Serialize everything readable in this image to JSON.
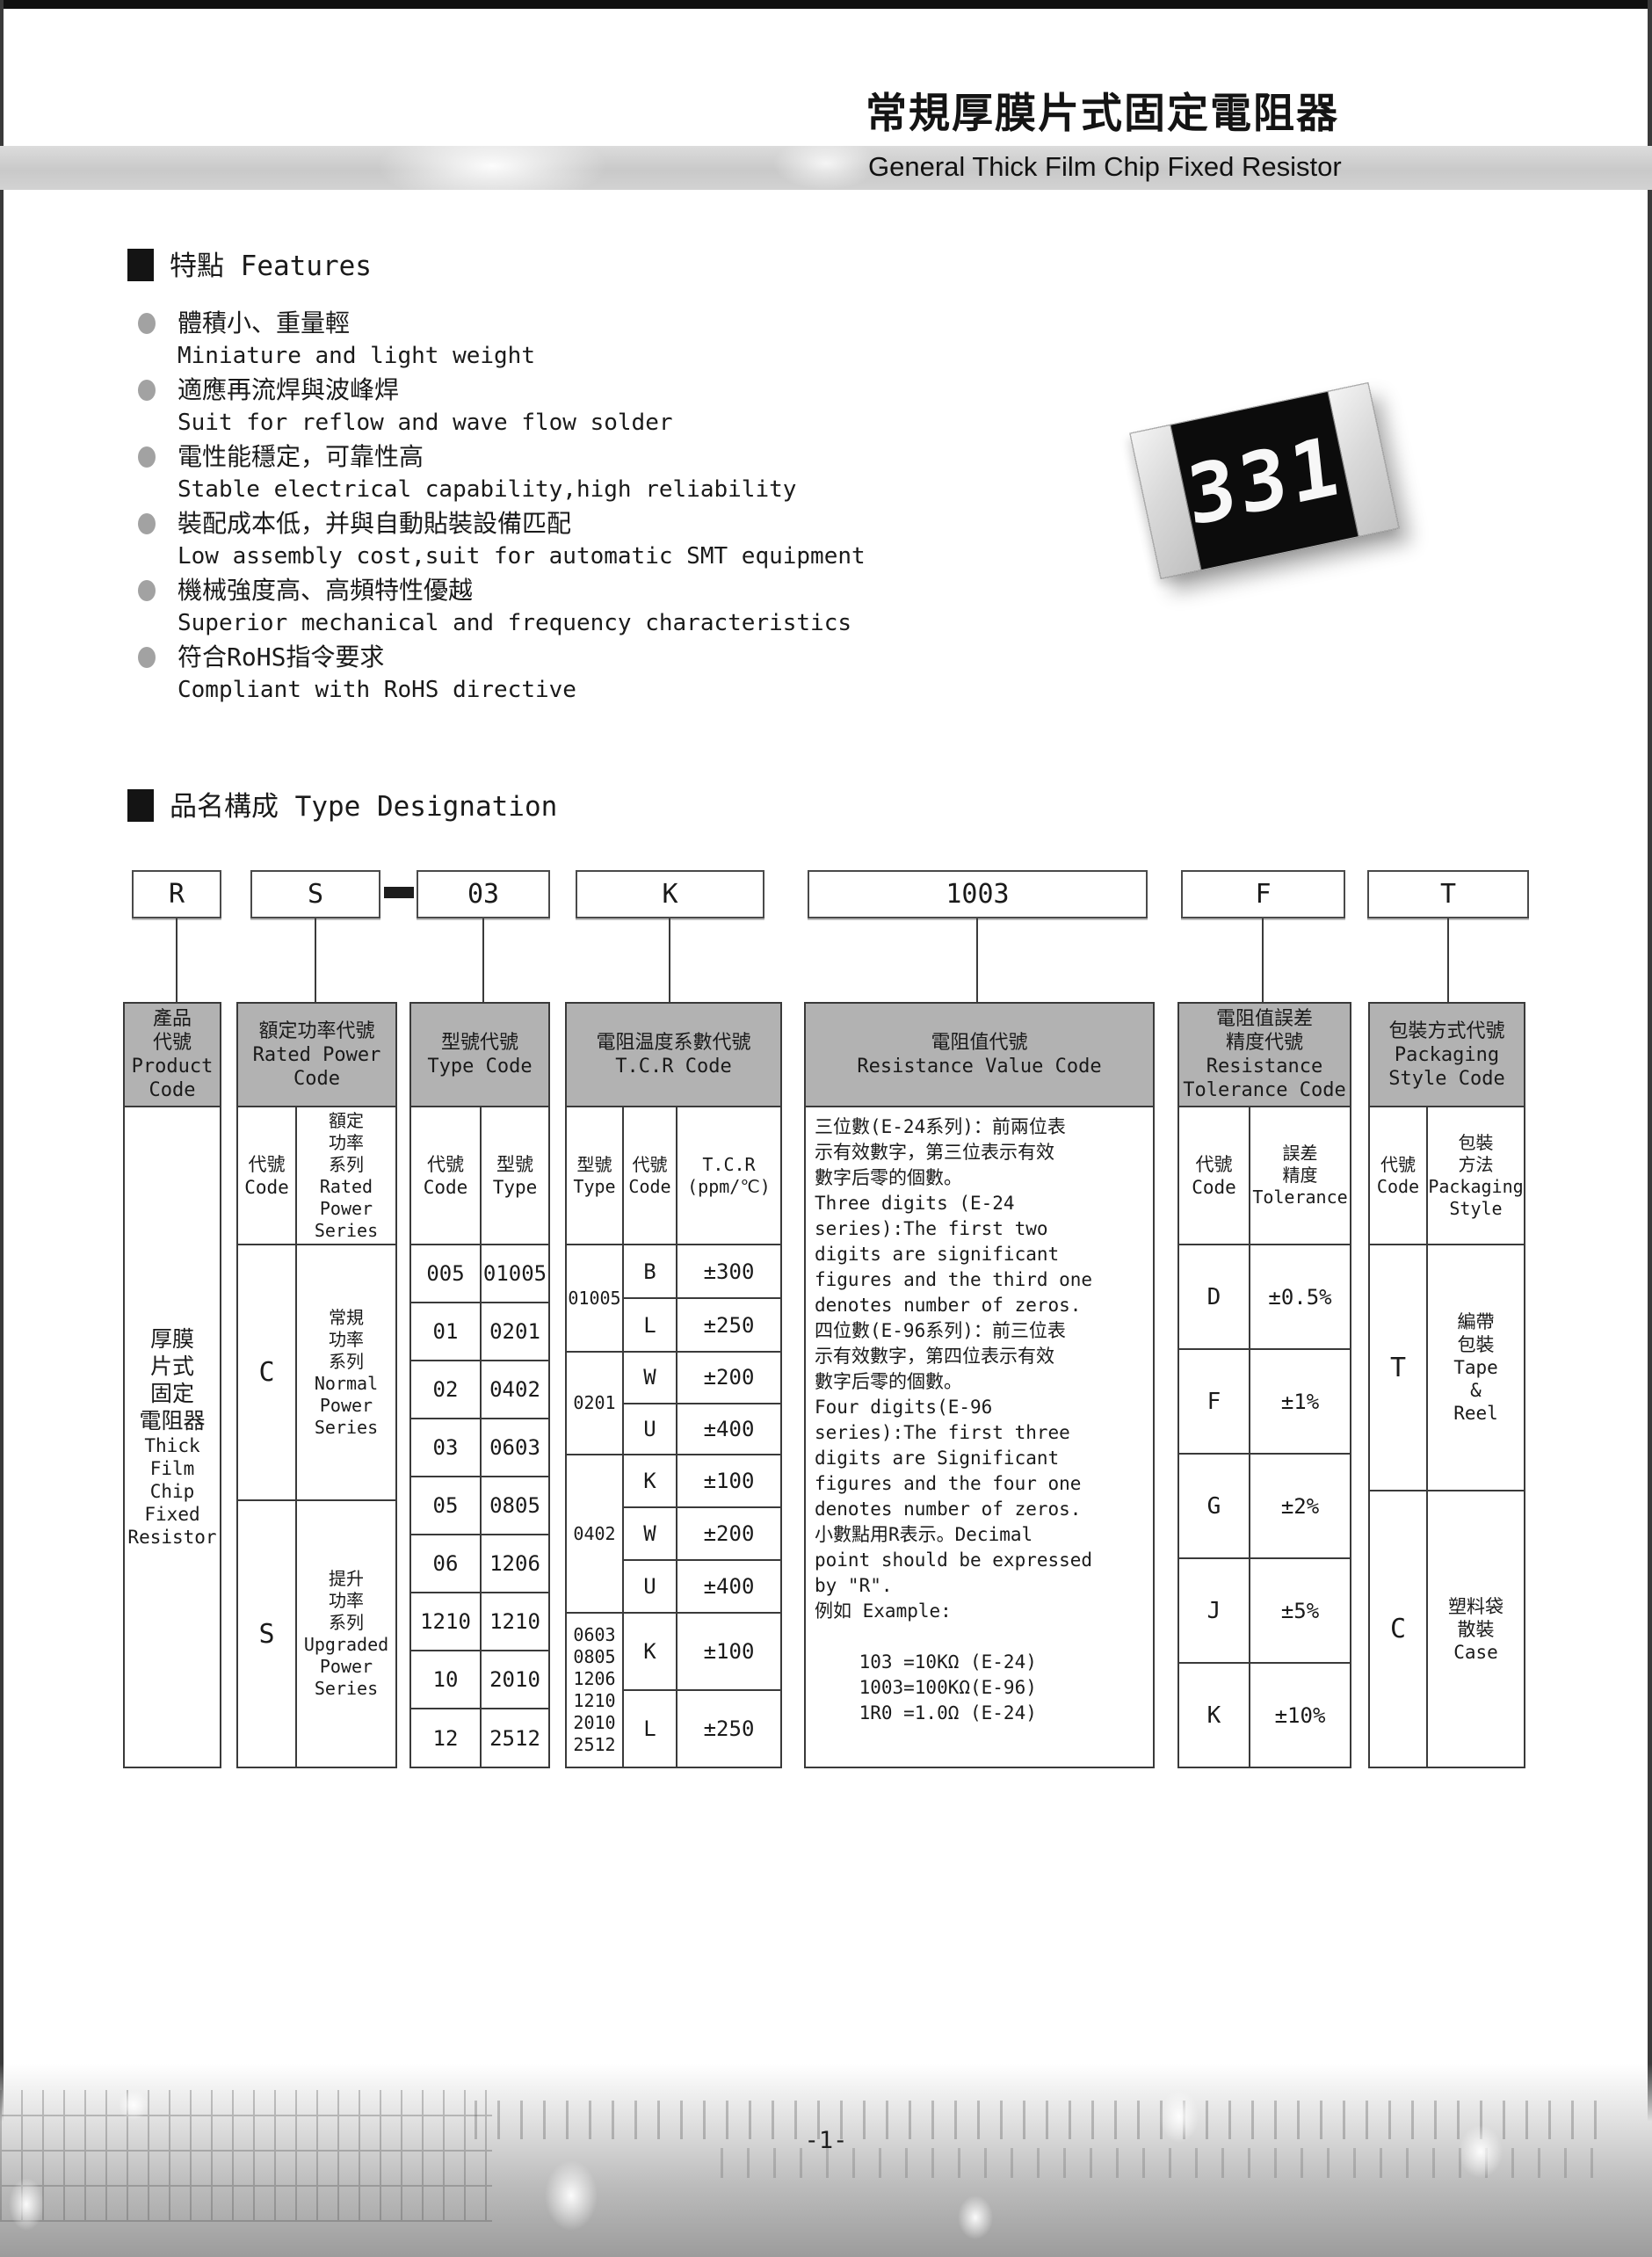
{
  "page": {
    "title_zh": "常規厚膜片式固定電阻器",
    "title_en": "General Thick Film Chip Fixed Resistor",
    "page_number": "-1-",
    "resistor_marking": "331"
  },
  "features": {
    "heading": "特點 Features",
    "items": [
      {
        "zh": "體積小、重量輕",
        "en": "Miniature and light weight"
      },
      {
        "zh": "適應再流焊與波峰焊",
        "en": "Suit for reflow and wave flow solder"
      },
      {
        "zh": "電性能穩定，可靠性高",
        "en": "Stable electrical capability,high reliability"
      },
      {
        "zh": "裝配成本低，并與自動貼裝設備匹配",
        "en": "Low assembly cost,suit for automatic SMT equipment"
      },
      {
        "zh": "機械強度高、高頻特性優越",
        "en": "Superior mechanical and frequency characteristics"
      },
      {
        "zh": "符合RoHS指令要求",
        "en": "Compliant with RoHS directive"
      }
    ]
  },
  "designation": {
    "heading": "品名構成  Type Designation",
    "boxes": {
      "b1": "R",
      "b2": "S",
      "b3": "03",
      "b4": "K",
      "b5": "1003",
      "b6": "F",
      "b7": "T"
    }
  },
  "table": {
    "product": {
      "header": "產品\n代號\nProduct\nCode",
      "body_zh": "厚膜\n片式\n固定\n電阻器",
      "body_en": "Thick\nFilm\nChip\nFixed\nResistor"
    },
    "power": {
      "header": "額定功率代號\nRated Power\nCode",
      "sub_code": "代號\nCode",
      "sub_series": "額定\n功率\n系列\nRated\nPower\nSeries",
      "rows": [
        {
          "code": "C",
          "series": "常規\n功率\n系列\nNormal\nPower\nSeries"
        },
        {
          "code": "S",
          "series": "提升\n功率\n系列\nUpgraded\nPower\nSeries"
        }
      ]
    },
    "type": {
      "header": "型號代號\nType Code",
      "sub_code": "代號\nCode",
      "sub_type": "型號\nType",
      "rows": [
        {
          "code": "005",
          "type": "01005"
        },
        {
          "code": "01",
          "type": "0201"
        },
        {
          "code": "02",
          "type": "0402"
        },
        {
          "code": "03",
          "type": "0603"
        },
        {
          "code": "05",
          "type": "0805"
        },
        {
          "code": "06",
          "type": "1206"
        },
        {
          "code": "1210",
          "type": "1210"
        },
        {
          "code": "10",
          "type": "2010"
        },
        {
          "code": "12",
          "type": "2512"
        }
      ]
    },
    "tcr": {
      "header": "電阻温度系數代號\nT.C.R Code",
      "sub_type": "型號\nType",
      "sub_code": "代號\nCode",
      "sub_tcr": "T.C.R\n(ppm/℃)",
      "groups": [
        {
          "type": "01005",
          "rows": [
            {
              "code": "B",
              "value": "±300"
            },
            {
              "code": "L",
              "value": "±250"
            }
          ]
        },
        {
          "type": "0201",
          "rows": [
            {
              "code": "W",
              "value": "±200"
            },
            {
              "code": "U",
              "value": "±400"
            }
          ]
        },
        {
          "type": "0402",
          "rows": [
            {
              "code": "K",
              "value": "±100"
            },
            {
              "code": "W",
              "value": "±200"
            },
            {
              "code": "U",
              "value": "±400"
            }
          ]
        },
        {
          "type": "0603\n0805\n1206\n1210\n2010\n2512",
          "rows": [
            {
              "code": "K",
              "value": "±100"
            },
            {
              "code": "L",
              "value": "±250"
            }
          ]
        }
      ]
    },
    "resistance": {
      "header": "電阻值代號\nResistance Value Code",
      "body": "三位數(E-24系列)：前兩位表\n示有效數字，第三位表示有效\n數字后零的個數。\nThree digits (E-24\nseries):The first two\ndigits are significant\nfigures and the third one\ndenotes number of zeros.\n四位數(E-96系列)：前三位表\n示有效數字，第四位表示有效\n數字后零的個數。\nFour digits(E-96\nseries):The first three\ndigits are Significant\nfigures and the four one\ndenotes number of zeros.\n小數點用R表示。Decimal\npoint should be expressed\nby \"R\".\n例如 Example:\n\n    103 =10KΩ (E-24)\n    1003=100KΩ(E-96)\n    1R0 =1.0Ω (E-24)"
    },
    "tolerance": {
      "header": "電阻值誤差\n精度代號\nResistance\nTolerance Code",
      "sub_code": "代號\nCode",
      "sub_tol": "誤差\n精度\nTolerance",
      "rows": [
        {
          "code": "D",
          "value": "±0.5%"
        },
        {
          "code": "F",
          "value": "±1%"
        },
        {
          "code": "G",
          "value": "±2%"
        },
        {
          "code": "J",
          "value": "±5%"
        },
        {
          "code": "K",
          "value": "±10%"
        }
      ]
    },
    "packaging": {
      "header": "包裝方式代號\nPackaging\nStyle Code",
      "sub_code": "代號\nCode",
      "sub_style": "包裝\n方法\nPackaging\nStyle",
      "rows": [
        {
          "code": "T",
          "style": "編帶\n包裝\nTape\n&\nReel"
        },
        {
          "code": "C",
          "style": "塑料袋\n散裝\nCase"
        }
      ]
    }
  }
}
